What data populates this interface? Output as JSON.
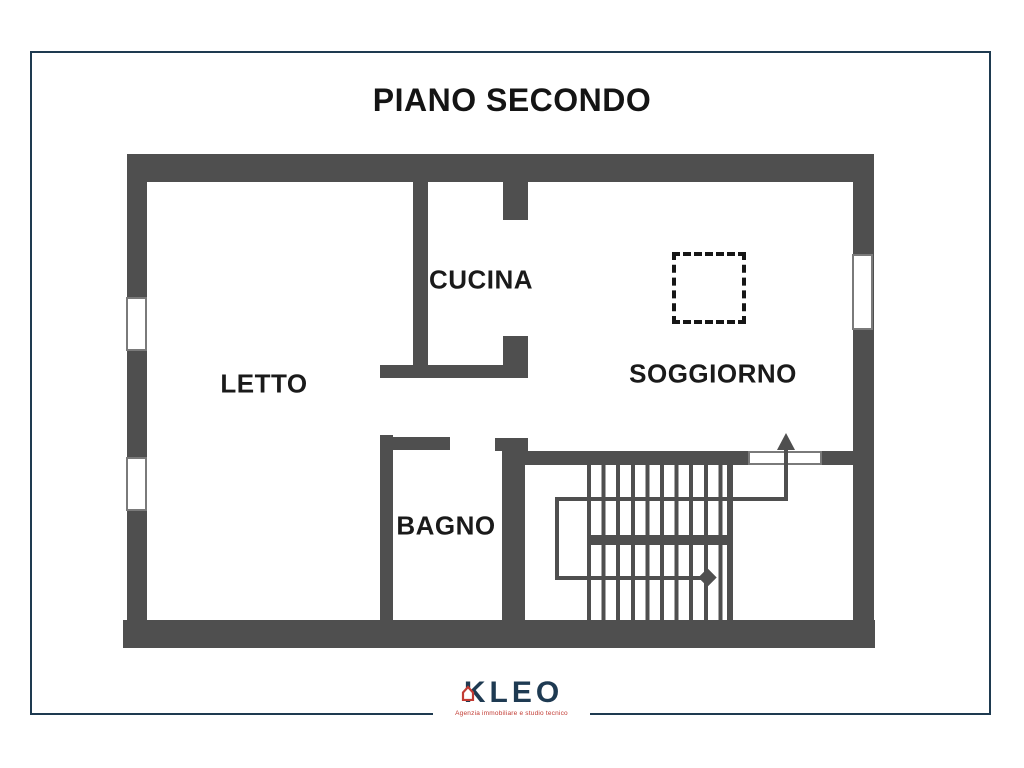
{
  "title": "PIANO SECONDO",
  "rooms": {
    "letto": "LETTO",
    "cucina": "CUCINA",
    "soggiorno": "SOGGIORNO",
    "bagno": "BAGNO"
  },
  "logo": {
    "name": "KLEO",
    "tagline": "Agenzia immobiliare e studio tecnico"
  },
  "colors": {
    "wall_gray": "#4f4f4f",
    "frame_navy": "#1e3a50",
    "logo_navy": "#1e3a52",
    "logo_red": "#c23b33",
    "label_black": "#1a1a1a"
  }
}
